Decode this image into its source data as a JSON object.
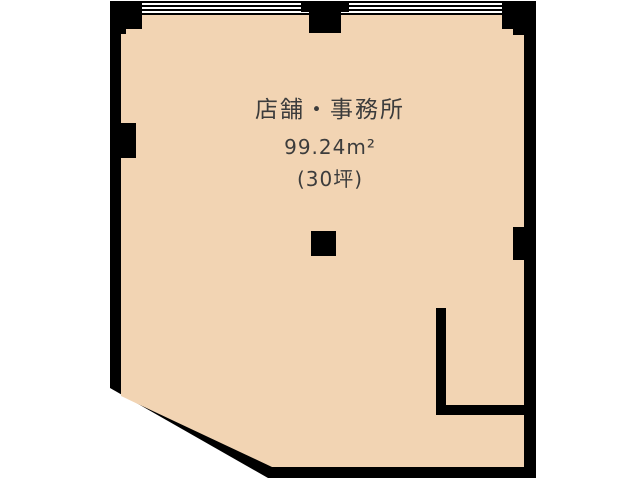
{
  "floor_plan": {
    "room": {
      "title": "店舗・事務所",
      "area_sqm": "99.24m²",
      "area_tsubo": "(30坪)"
    },
    "colors": {
      "wall": "#000000",
      "floor_fill": "#f2d4b3",
      "window_gap": "#ffffff",
      "label_text": "#3c3c3c",
      "background": "#ffffff"
    }
  }
}
